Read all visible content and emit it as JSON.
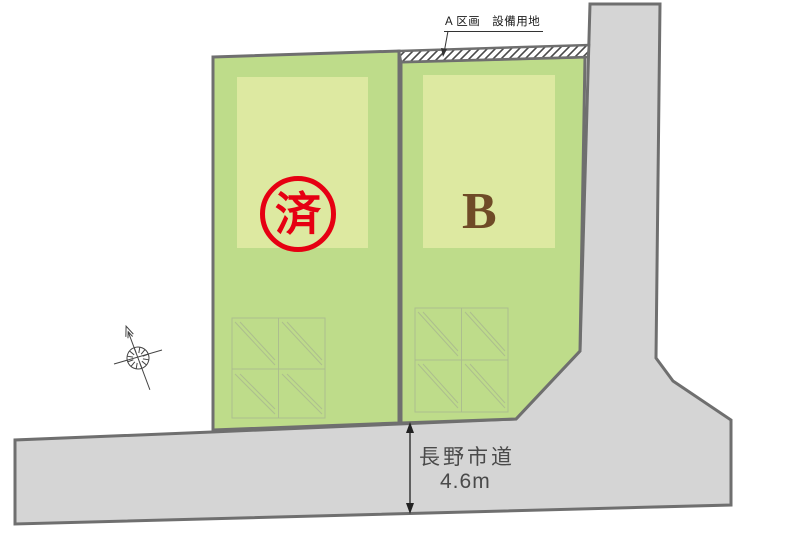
{
  "diagram": {
    "type": "real-estate-site-plan",
    "annotation": {
      "label": "A 区画　設備用地"
    },
    "plots": {
      "sold": {
        "stamp": "済",
        "status": "sold"
      },
      "b": {
        "label": "B"
      }
    },
    "road": {
      "name": "長野市道",
      "width": "4.6m"
    },
    "colors": {
      "plot_green": "#bedc8a",
      "building_footprint_green": "#dde9a1",
      "road_fill": "#d5d5d5",
      "boundary_gray": "#6f6f6f",
      "stamp_red": "#e60012",
      "plot_label_brown": "#6f4b27",
      "parking_grid_line": "#a9b98e"
    },
    "icons": {
      "compass": "north-compass"
    }
  }
}
